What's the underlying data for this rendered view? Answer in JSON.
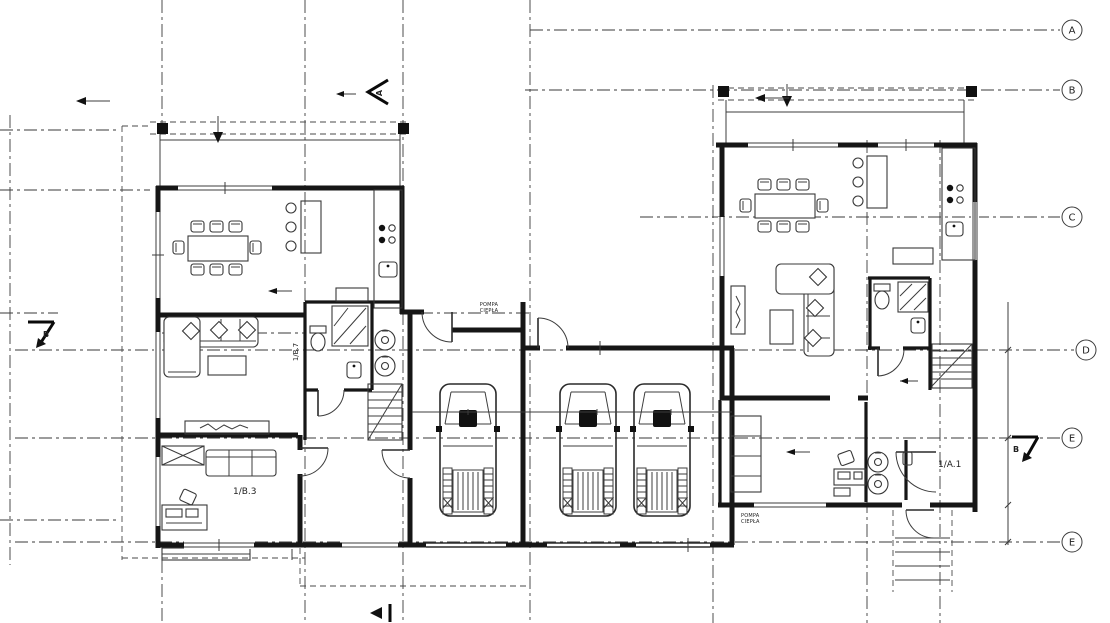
{
  "colors": {
    "background": "#ffffff",
    "line": "#1a1a1a"
  },
  "grid": [
    {
      "label": "A"
    },
    {
      "label": "B"
    },
    {
      "label": "C"
    },
    {
      "label": "D"
    },
    {
      "label": "E"
    },
    {
      "label": "E"
    }
  ],
  "section_markers": {
    "top": "A",
    "left": "B",
    "right": "B"
  },
  "room_labels": {
    "unit_b_room": "1/B.3",
    "unit_b_bath": "1/B.7",
    "unit_a_room": "1/A.1"
  },
  "annotations": {
    "heat_pump_line1": "POMPA",
    "heat_pump_line2": "CIEPŁA"
  }
}
